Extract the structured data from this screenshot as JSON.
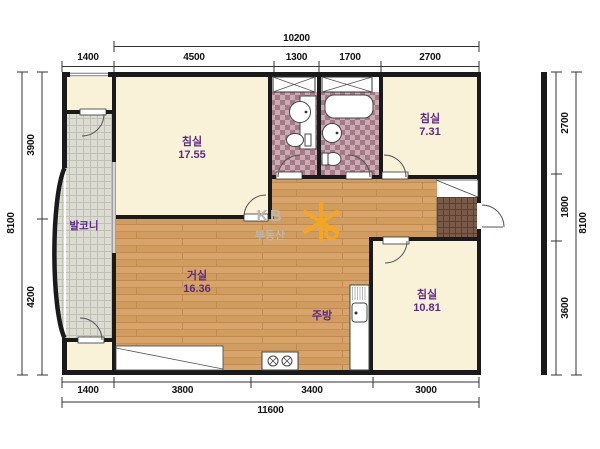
{
  "rooms": {
    "bedroom_main": {
      "name": "침실",
      "area": "17.55"
    },
    "bedroom_small": {
      "name": "침실",
      "area": "7.31"
    },
    "bedroom_bottom": {
      "name": "침실",
      "area": "10.81"
    },
    "living": {
      "name": "거실",
      "area": "16.36"
    },
    "kitchen": {
      "name": "주방"
    },
    "balcony": {
      "name": "발코니"
    }
  },
  "dims": {
    "top": {
      "total": "10200",
      "segments": [
        "1400",
        "4500",
        "1300",
        "1700",
        "2700"
      ]
    },
    "bottom": {
      "total": "11600",
      "segments": [
        "1400",
        "3800",
        "3400",
        "3000"
      ]
    },
    "left": {
      "total": "8100",
      "segments": [
        "3900",
        "4200"
      ]
    },
    "right": {
      "total": "8100",
      "segments": [
        "2700",
        "1800",
        "3600"
      ]
    }
  },
  "watermark": {
    "brand": "KB",
    "sub": "부동산"
  },
  "colors": {
    "wall": "#1A1A1A",
    "room_fill": "#FAF2D8",
    "wood_floor": "#D8A469",
    "balcony_tile": "#DCDCD3",
    "bath_tile": "#C9ABB2",
    "bath_tile_dark": "#A57987",
    "entry_tile": "#7A5A48",
    "room_label": "#5B2A86",
    "logo_orange": "#F8A81C",
    "watermark_gray": "#BEB7AF"
  }
}
